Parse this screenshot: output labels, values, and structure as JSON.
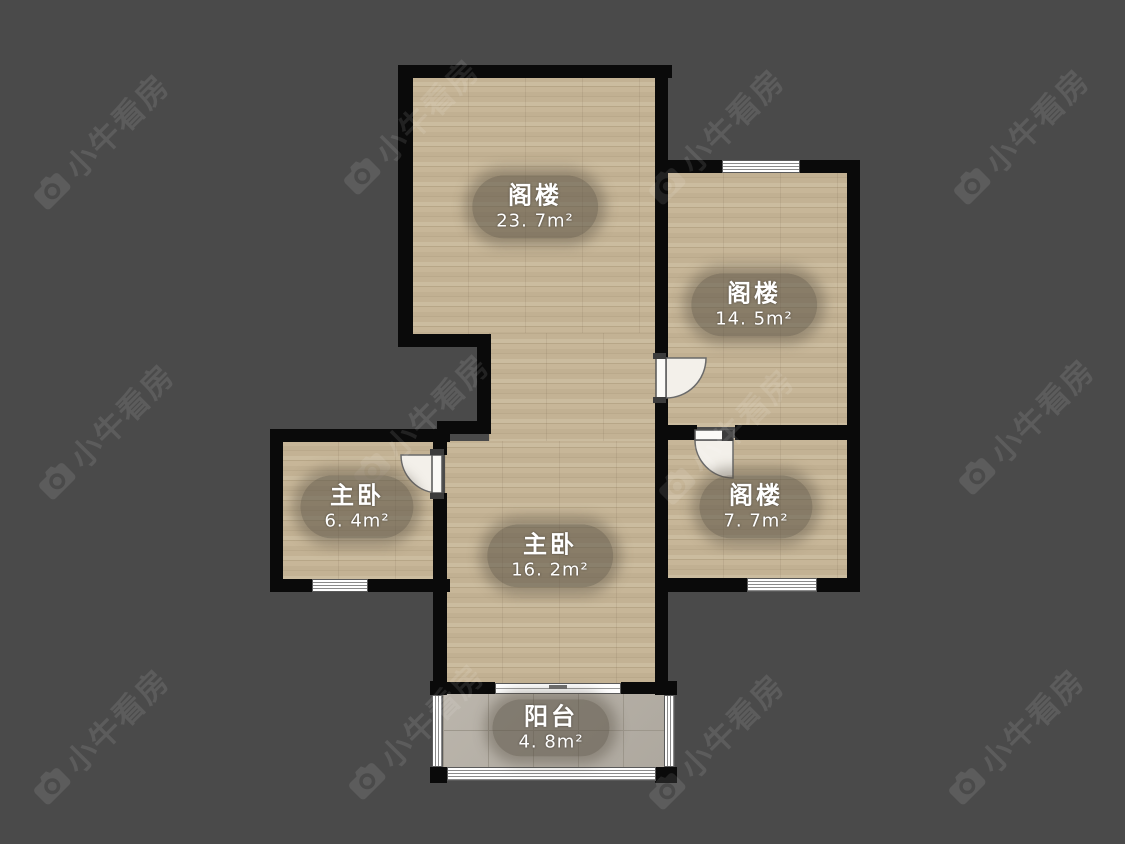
{
  "app": {
    "watermark_text": "小牛看房",
    "watermark_icon": "camera-icon"
  },
  "floorplan": {
    "rooms": [
      {
        "name": "阁楼",
        "area": "23. 7m²"
      },
      {
        "name": "阁楼",
        "area": "14. 5m²"
      },
      {
        "name": "主卧",
        "area": "6. 4m²"
      },
      {
        "name": "主卧",
        "area": "16. 2m²"
      },
      {
        "name": "阁楼",
        "area": "7. 7m²"
      },
      {
        "name": "阳台",
        "area": "4. 8m²"
      }
    ],
    "door_count": 3,
    "window_count": 7
  },
  "colors": {
    "background": "#4a4a4a",
    "wall": "#0a0a0a",
    "floor_wood": "#c2b193",
    "floor_tile": "#b7b1a7",
    "label_background": "rgba(86,78,66,0.55)",
    "label_text": "#ffffff",
    "watermark": "rgba(255,255,255,0.10)"
  }
}
